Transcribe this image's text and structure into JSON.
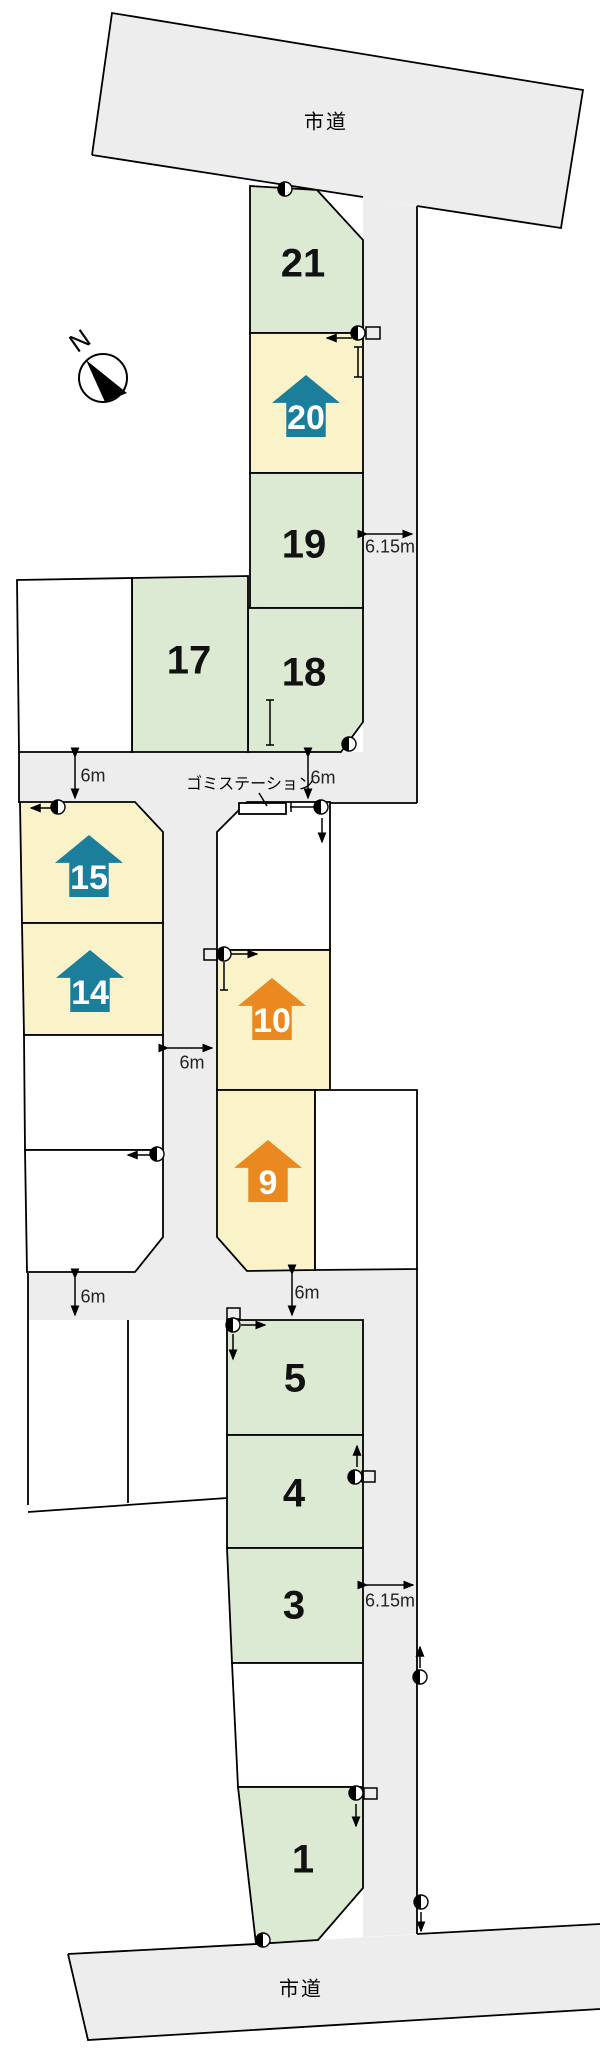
{
  "page": {
    "type": "subdivision-site-plan"
  },
  "roads": {
    "top_label": "市道",
    "bottom_label": "市道"
  },
  "compass": {
    "label": "N"
  },
  "garbage_station": {
    "label": "ゴミステーション"
  },
  "dimensions": {
    "upper_road_width": "6.15m",
    "lower_road_width": "6.15m",
    "upper_band_left": "6m",
    "upper_band_right": "6m",
    "middle_road": "6m",
    "lower_band_left": "6m",
    "lower_band_right": "6m"
  },
  "lots": {
    "lot21": {
      "label": "21",
      "fill": "green"
    },
    "lot20": {
      "label": "20",
      "fill": "yellow",
      "marker": "teal-house"
    },
    "lot19": {
      "label": "19",
      "fill": "green"
    },
    "lot18": {
      "label": "18",
      "fill": "green"
    },
    "lot17": {
      "label": "17",
      "fill": "green"
    },
    "lot15": {
      "label": "15",
      "fill": "yellow",
      "marker": "teal-house"
    },
    "lot14": {
      "label": "14",
      "fill": "yellow",
      "marker": "teal-house"
    },
    "lot10": {
      "label": "10",
      "fill": "yellow",
      "marker": "orange-house"
    },
    "lot9": {
      "label": "9",
      "fill": "yellow",
      "marker": "orange-house"
    },
    "lot5": {
      "label": "5",
      "fill": "green"
    },
    "lot4": {
      "label": "4",
      "fill": "green"
    },
    "lot3": {
      "label": "3",
      "fill": "green"
    },
    "lot1": {
      "label": "1",
      "fill": "green"
    }
  },
  "colors": {
    "lot_green": "#dcead3",
    "lot_yellow": "#faf3c9",
    "road_gray": "#ededed",
    "house_teal": "#1b7e9b",
    "house_orange": "#e9891f",
    "line": "#000000"
  }
}
